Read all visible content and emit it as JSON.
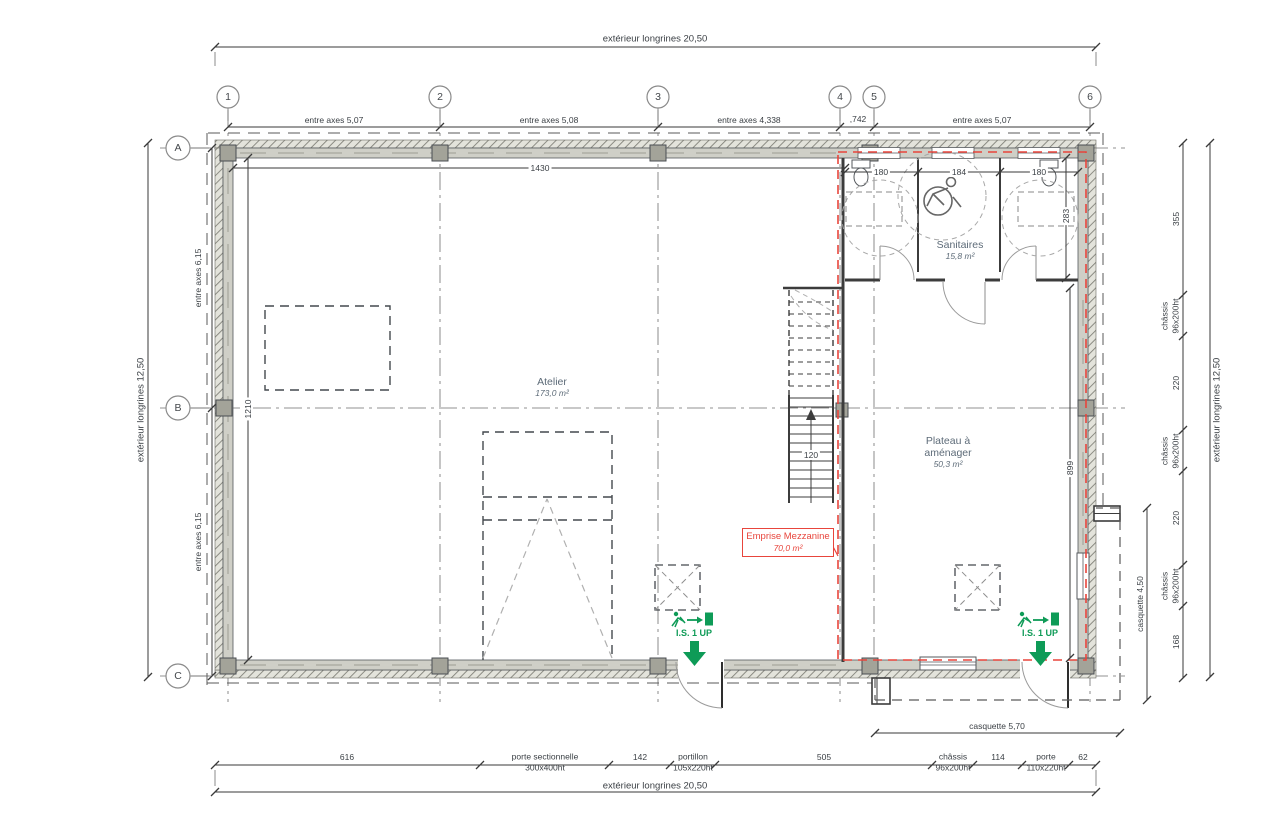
{
  "drawing": {
    "grid": {
      "columns": [
        "1",
        "2",
        "3",
        "4",
        "5",
        "6"
      ],
      "rows": [
        "A",
        "B",
        "C"
      ]
    },
    "dimensions": {
      "top_exterior": "extérieur longrines 20,50",
      "bottom_exterior": "extérieur longrines 20,50",
      "left_exterior": "extérieur longrines 12,50",
      "right_exterior": "extérieur longrines 12,50",
      "column_spans": [
        "entre axes 5,07",
        "entre axes 5,08",
        "entre axes 4,338",
        ",742",
        "entre axes 5,07"
      ],
      "row_spans": [
        "entre axes 6,15",
        "entre axes 6,15"
      ],
      "right_side": {
        "seg1": "355",
        "seg2": "220",
        "seg3": "220",
        "seg4": "168",
        "chassis_label": "châssis",
        "chassis_size": "96x200ht"
      },
      "casquette_right": "casquette 4,50",
      "casquette_bottom": "casquette 5,70",
      "bottom_side": {
        "seg1": "616",
        "seg2": "142",
        "seg3": "505",
        "seg4": "114",
        "seg5": "62",
        "porte_sectionnelle_label": "porte sectionnelle",
        "porte_sectionnelle_size": "300x400ht",
        "portillon_label": "portillon",
        "portillon_size": "105x220ht",
        "chassis_label": "châssis",
        "chassis_size": "96x200ht",
        "porte_label": "porte",
        "porte_size": "110x220ht"
      },
      "interior": {
        "wall_1430": "1430",
        "wall_1210": "1210",
        "stair_120": "120",
        "san_left": "180",
        "san_center": "184",
        "san_right": "180",
        "san_depth": "283",
        "plateau_depth": "899"
      }
    },
    "rooms": {
      "atelier": {
        "name": "Atelier",
        "area": "173,0 m²"
      },
      "sanitaires": {
        "name": "Sanitaires",
        "area": "15,8 m²"
      },
      "plateau": {
        "name": "Plateau à aménager",
        "area": "50,3 m²"
      },
      "mezzanine": {
        "name": "Emprise Mezzanine",
        "area": "70,0 m²"
      }
    },
    "annotations": {
      "exit_label": "I.S. 1 UP"
    },
    "colors": {
      "red": "#e8453c",
      "green": "#0e9b57",
      "wall_gray": "#cfcfc7",
      "column_gray": "#a3a399",
      "dim_text": "#3a3f44",
      "room_text": "#5d6b78"
    }
  }
}
